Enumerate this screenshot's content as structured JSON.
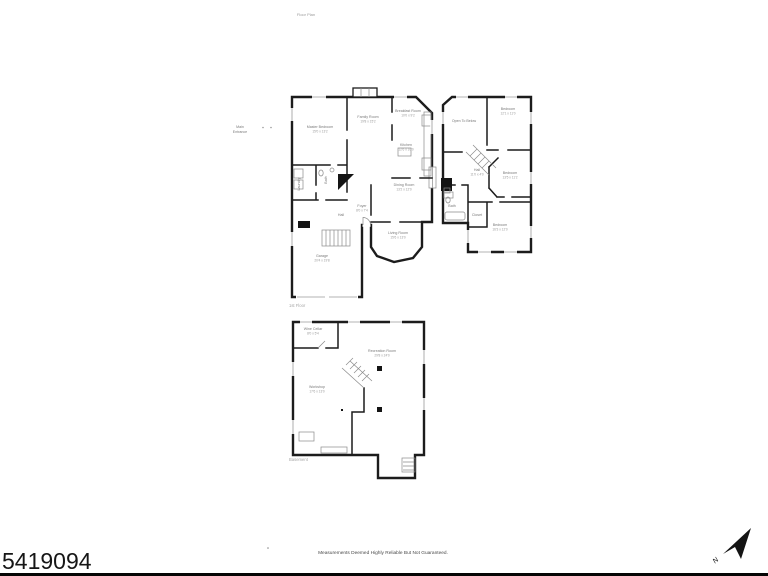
{
  "title": {
    "top_label": "Floor Plan"
  },
  "annotations": {
    "side_note_line1": "Main",
    "side_note_line2": "Entrance"
  },
  "floors": {
    "first": {
      "caption": "1st Floor",
      "rooms": {
        "master": {
          "name": "Master Bedroom",
          "dims": "15'0 x 13'2"
        },
        "family": {
          "name": "Family Room",
          "dims": "19'8 x 15'2"
        },
        "breakfast": {
          "name": "Breakfast Room",
          "dims": "10'0 x 9'2"
        },
        "kitchen": {
          "name": "Kitchen",
          "dims": "12'6 x 10'0"
        },
        "dining": {
          "name": "Dining Room",
          "dims": "13'2 x 12'0"
        },
        "living": {
          "name": "Living Room",
          "dims": "15'6 x 13'0"
        },
        "foyer": {
          "name": "Foyer",
          "dims": "8'0 x 7'4"
        },
        "hall": {
          "name": "Hall"
        },
        "laundry": {
          "name": "Laundry"
        },
        "bath": {
          "name": "Bath"
        },
        "garage": {
          "name": "Garage",
          "dims": "20'4 x 19'8"
        }
      }
    },
    "second": {
      "rooms": {
        "open_to_below": {
          "name": "Open To Below"
        },
        "bedroom_front": {
          "name": "Bedroom",
          "dims": "12'1 x 11'0"
        },
        "bedroom_middle": {
          "name": "Bedroom",
          "dims": "13'5 x 11'2"
        },
        "bedroom_rear": {
          "name": "Bedroom",
          "dims": "16'3 x 12'0"
        },
        "hall": {
          "name": "Hall",
          "dims": "11'0 x 4'0"
        },
        "bath": {
          "name": "Bath"
        },
        "closet": {
          "name": "Closet"
        }
      }
    },
    "basement": {
      "caption": "Basement",
      "rooms": {
        "wine_cellar": {
          "name": "Wine Cellar",
          "dims": "8'0 x 5'4"
        },
        "recreation": {
          "name": "Recreation Room",
          "dims": "29'8 x 24'0"
        },
        "workshop": {
          "name": "Workshop",
          "dims": "17'6 x 13'0"
        }
      }
    }
  },
  "footer": {
    "mls_number": "5419094",
    "disclaimer": "Measurements Deemed Highly Reliable But Not Guaranteed.",
    "compass_label": "N"
  },
  "colors": {
    "wall": "#1c1c1c",
    "thin_line": "#8a8a8a",
    "label": "#7a7a7a",
    "accent": "#000000"
  }
}
